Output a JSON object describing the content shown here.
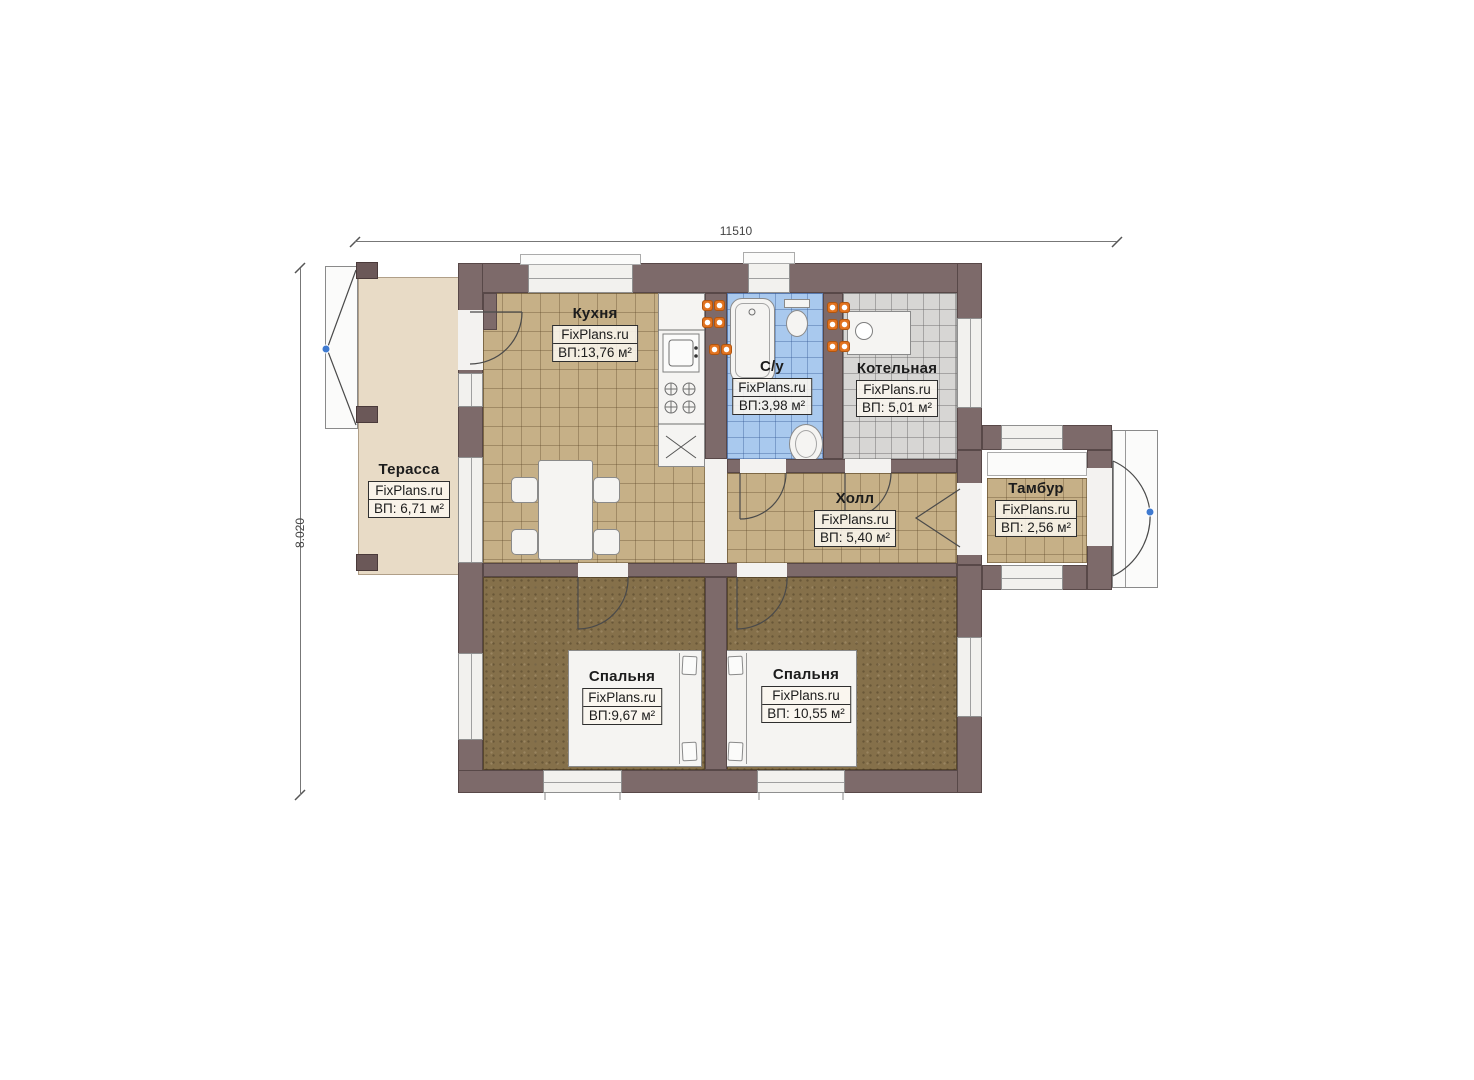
{
  "plan": {
    "dimension_width": "11510",
    "dimension_height": "8.020",
    "watermark": "FixPlans.ru"
  },
  "rooms": [
    {
      "id": "terrace",
      "name": "Терасса",
      "brand": "FixPlans.ru",
      "area": "ВП: 6,71 м²"
    },
    {
      "id": "kitchen",
      "name": "Кухня",
      "brand": "FixPlans.ru",
      "area": "ВП:13,76 м²"
    },
    {
      "id": "bathroom",
      "name": "С/у",
      "brand": "FixPlans.ru",
      "area": "ВП:3,98 м²"
    },
    {
      "id": "boiler",
      "name": "Котельная",
      "brand": "FixPlans.ru",
      "area": "ВП: 5,01 м²"
    },
    {
      "id": "hall",
      "name": "Холл",
      "brand": "FixPlans.ru",
      "area": "ВП: 5,40 м²"
    },
    {
      "id": "vestibule",
      "name": "Тамбур",
      "brand": "FixPlans.ru",
      "area": "ВП: 2,56 м²"
    },
    {
      "id": "bedroom-1",
      "name": "Спальня",
      "brand": "FixPlans.ru",
      "area": "ВП:9,67 м²"
    },
    {
      "id": "bedroom-2",
      "name": "Спальня",
      "brand": "FixPlans.ru",
      "area": "ВП: 10,55 м²"
    }
  ],
  "colors": {
    "wall": "#7d6a6a",
    "terrace_floor": "#e8dbc6",
    "tile_floor_tan": "#c6b087",
    "tile_floor_blue": "#a9c9ee",
    "tile_floor_gray": "#d7d6d4",
    "bedroom_floor": "#85704a",
    "fixture_white": "#f5f4f2",
    "radiator_orange": "#e2731f",
    "door_pivot_blue": "#3f7ad0"
  }
}
